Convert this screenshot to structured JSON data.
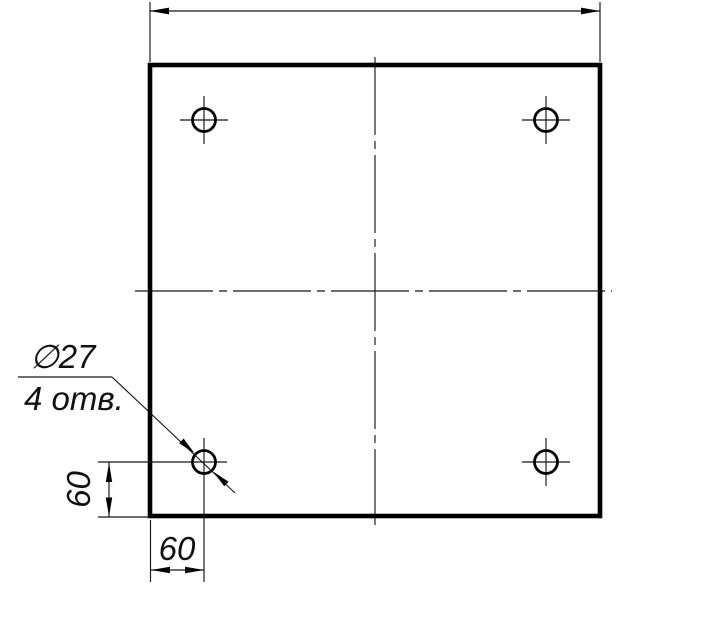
{
  "drawing": {
    "colors": {
      "paper": "#ffffff",
      "ink": "#000000"
    },
    "callout": {
      "diameter_label": "∅27",
      "count_label": "4 отв."
    },
    "dimensions": {
      "left_offset": "60",
      "bottom_offset": "60"
    }
  }
}
